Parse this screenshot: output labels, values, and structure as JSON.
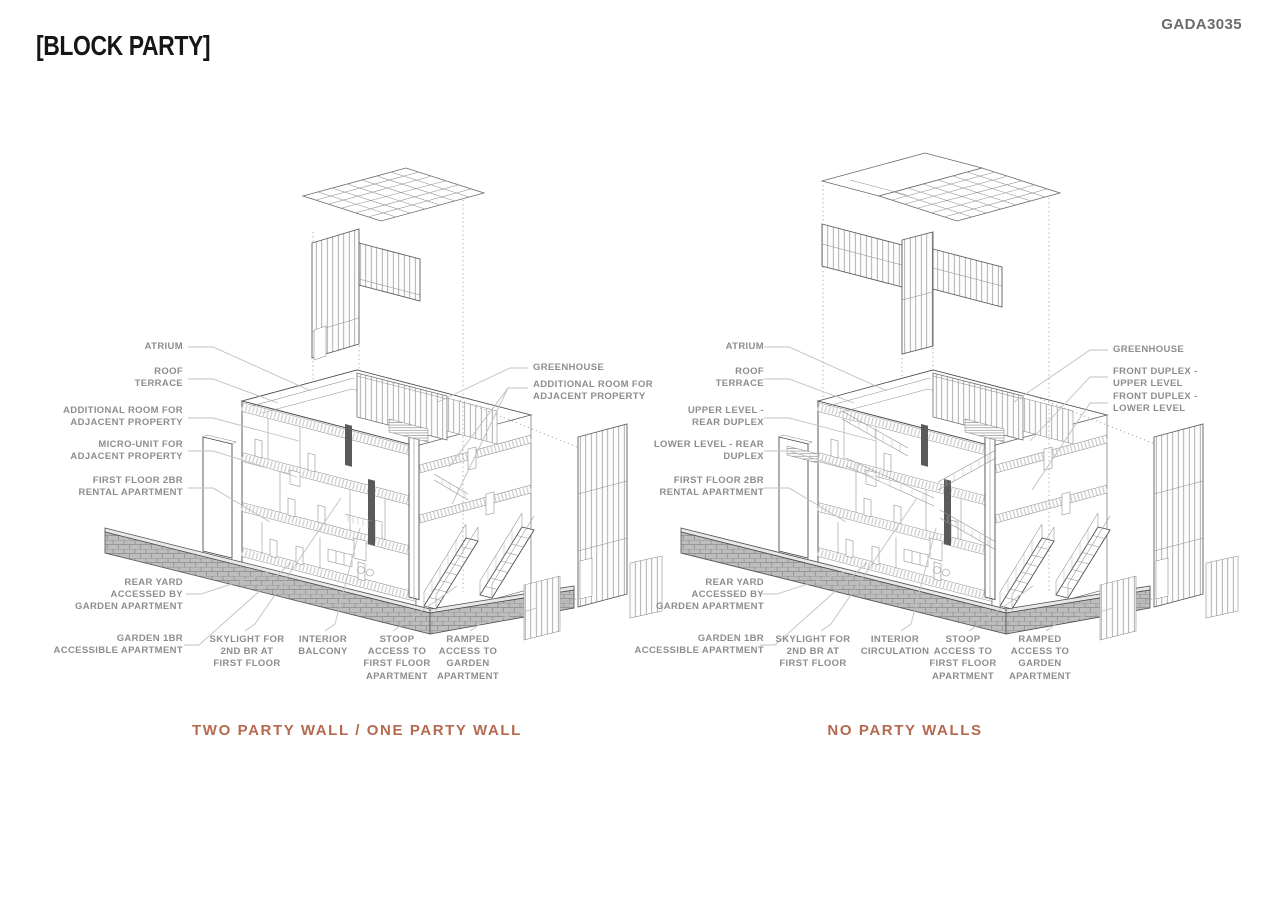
{
  "header": {
    "title": "[BLOCK PARTY]",
    "project_code": "GADA3035"
  },
  "colors": {
    "caption_accent": "#b5694f",
    "label_gray": "#8d8d8d",
    "drawing_line": "#4e4e4e",
    "title_black": "#161616",
    "code_gray": "#6b6b6b",
    "background": "#ffffff"
  },
  "diagrams": [
    {
      "caption": "TWO PARTY WALL / ONE PARTY WALL",
      "labels_left": [
        "ATRIUM",
        "ROOF\nTERRACE",
        "ADDITIONAL ROOM FOR\nADJACENT PROPERTY",
        "MICRO-UNIT FOR\nADJACENT PROPERTY",
        "FIRST FLOOR 2BR\nRENTAL APARTMENT",
        "REAR YARD\nACCESSED BY\nGARDEN APARTMENT",
        "GARDEN 1BR\nACCESSIBLE APARTMENT"
      ],
      "labels_right": [
        "GREENHOUSE",
        "ADDITIONAL ROOM FOR\nADJACENT PROPERTY"
      ],
      "labels_bottom": [
        "SKYLIGHT FOR\n2ND BR AT\nFIRST FLOOR",
        "INTERIOR\nBALCONY",
        "STOOP\nACCESS TO\nFIRST FLOOR\nAPARTMENT",
        "RAMPED\nACCESS TO\nGARDEN\nAPARTMENT"
      ]
    },
    {
      "caption": "NO PARTY WALLS",
      "labels_left": [
        "ATRIUM",
        "ROOF\nTERRACE",
        "UPPER LEVEL -\nREAR DUPLEX",
        "LOWER LEVEL - REAR\nDUPLEX",
        "FIRST FLOOR 2BR\nRENTAL APARTMENT",
        "REAR YARD\nACCESSED BY\nGARDEN APARTMENT",
        "GARDEN 1BR\nACCESSIBLE APARTMENT"
      ],
      "labels_right": [
        "GREENHOUSE",
        "FRONT DUPLEX -\nUPPER LEVEL",
        "FRONT DUPLEX -\nLOWER LEVEL"
      ],
      "labels_bottom": [
        "SKYLIGHT FOR\n2ND BR AT\nFIRST FLOOR",
        "INTERIOR\nCIRCULATION",
        "STOOP\nACCESS TO\nFIRST FLOOR\nAPARTMENT",
        "RAMPED\nACCESS TO\nGARDEN\nAPARTMENT"
      ]
    }
  ]
}
